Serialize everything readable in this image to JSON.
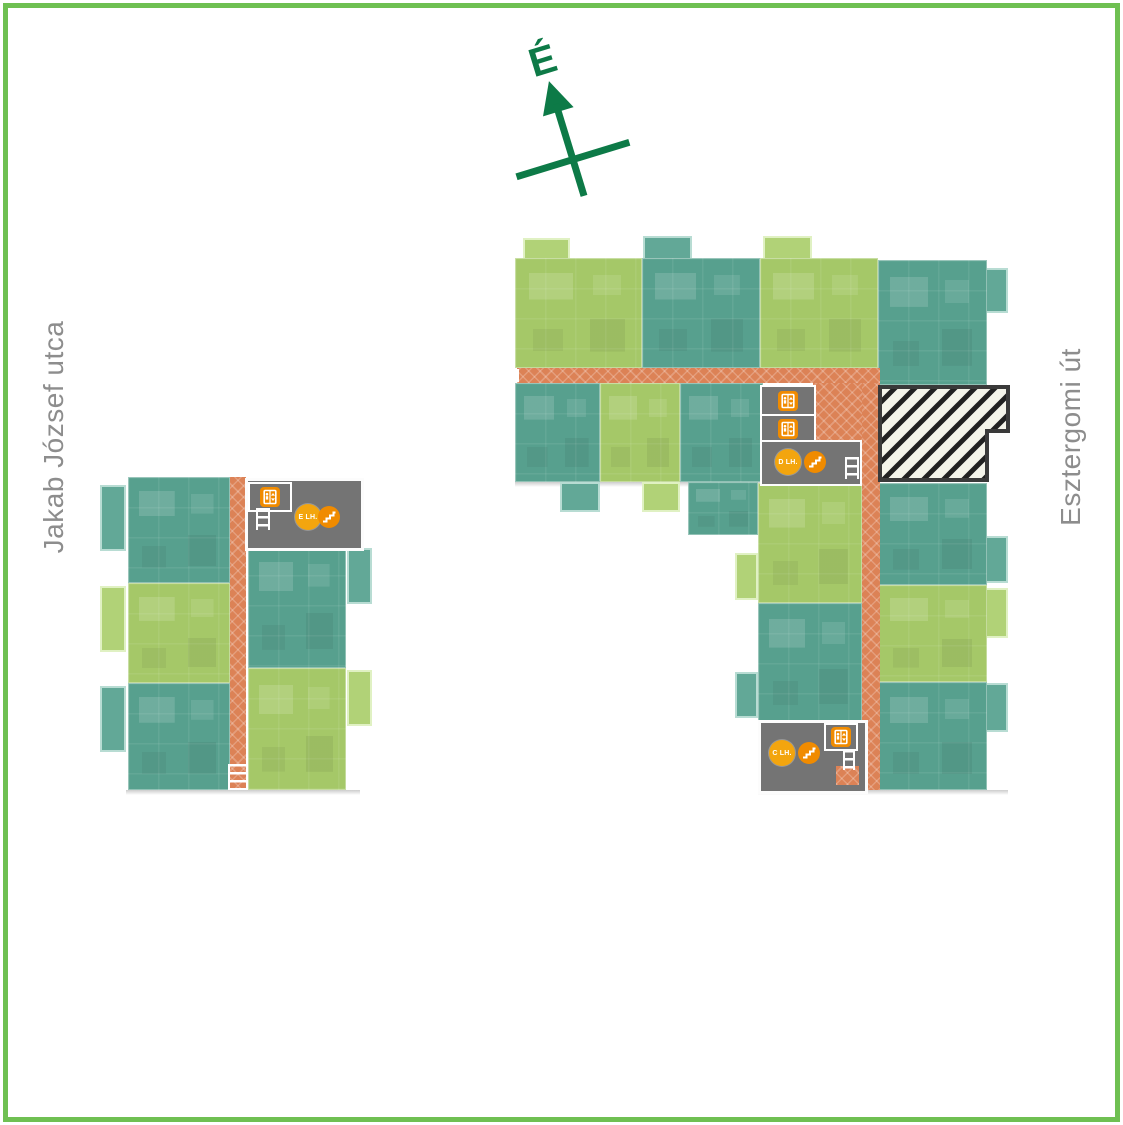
{
  "page": {
    "background": "#ffffff",
    "frame_color": "#6fc052"
  },
  "compass": {
    "north_label": "É",
    "color": "#0d7a47"
  },
  "streets": {
    "left_label": "Jakab József utca",
    "right_label": "Esztergomi út",
    "label_color": "#8d8d8d"
  },
  "colors": {
    "apartment_green": "#a5c868",
    "apartment_teal": "#57a08e",
    "corridor_orange": "#dc8256",
    "stairwell_gray": "#747474",
    "icon_orange": "#f08b00",
    "lift_badge_orange": "#f3a50e",
    "hatch_background": "#f4f4ea",
    "hatch_stripe": "#212121"
  },
  "stair_cores": {
    "left_building": {
      "lift_label": "E LH."
    },
    "right_building_mid": {
      "lift_label": "D LH."
    },
    "right_building_south": {
      "lift_label": "C LH."
    }
  }
}
